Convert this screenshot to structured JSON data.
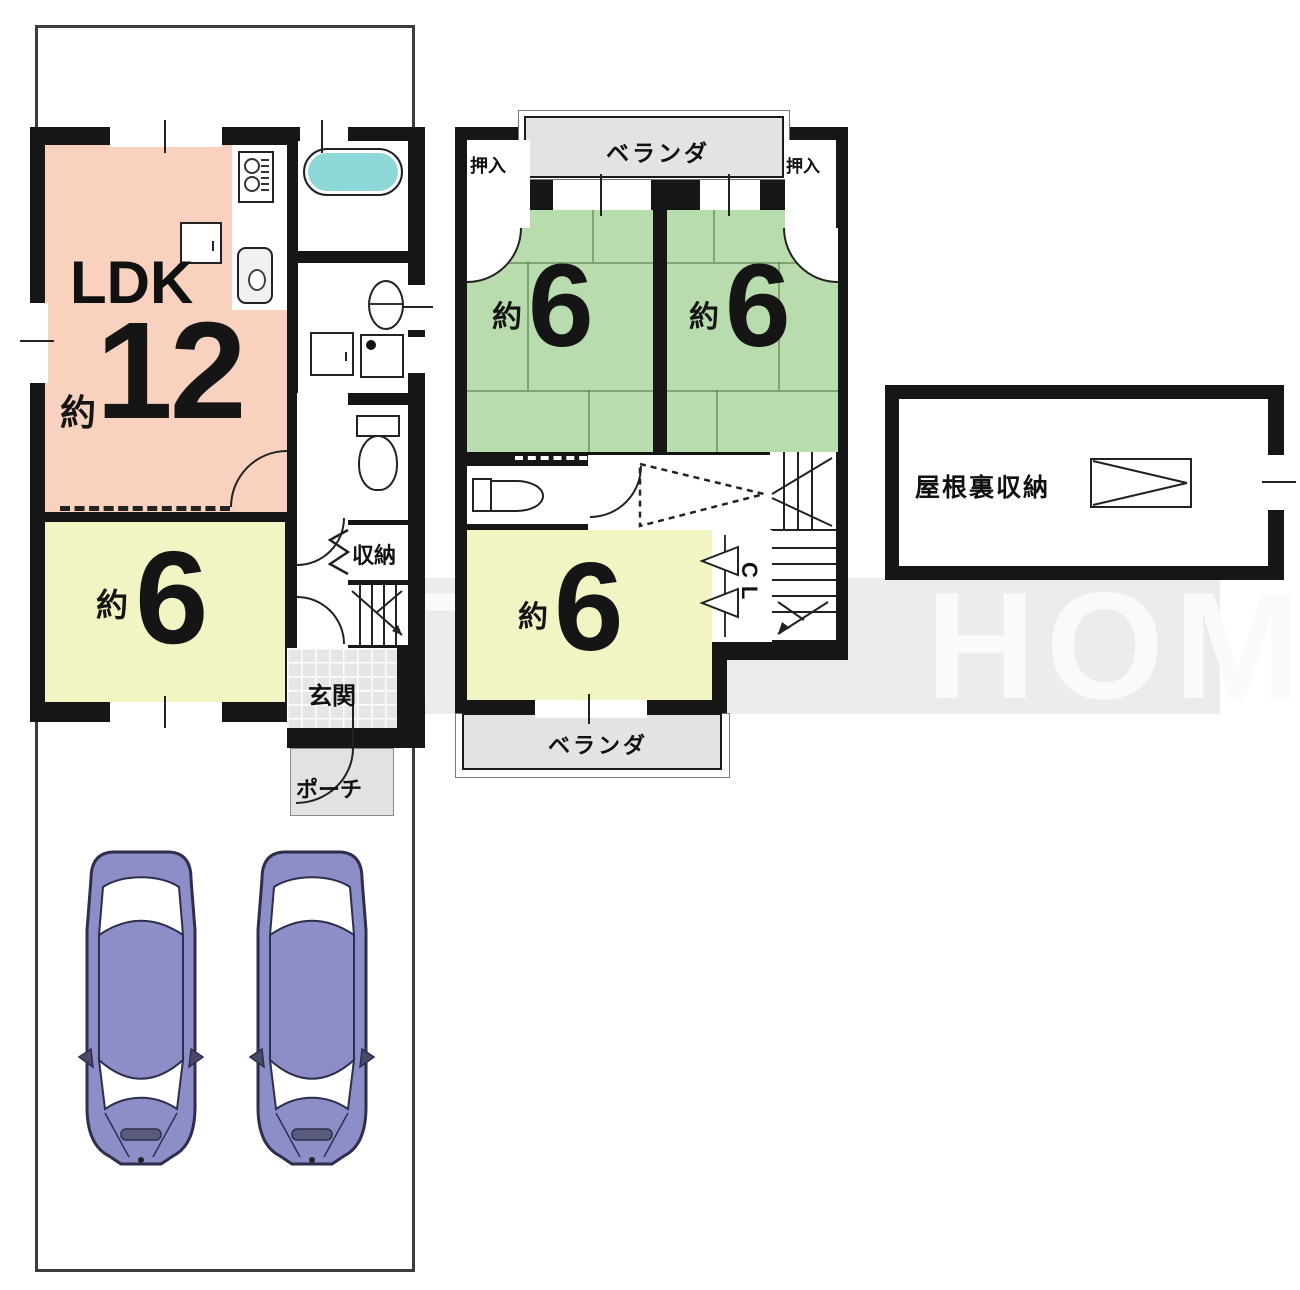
{
  "watermark": {
    "word1": "AFTER",
    "word2": "HOME"
  },
  "floor1": {
    "ldk": {
      "name": "LDK",
      "approx": "約",
      "area": "12"
    },
    "south_room": {
      "approx": "約",
      "area": "6"
    },
    "storage": "収納",
    "entrance": "玄関",
    "porch": "ポーチ"
  },
  "floor2": {
    "north_balcony": "ベランダ",
    "south_balcony": "ベランダ",
    "closet_left": "押入",
    "closet_right": "押入",
    "tatami_left": {
      "approx": "約",
      "area": "6"
    },
    "tatami_right": {
      "approx": "約",
      "area": "6"
    },
    "south_room": {
      "approx": "約",
      "area": "6"
    },
    "closet": "CL"
  },
  "attic": {
    "label": "屋根裏収納"
  },
  "colors": {
    "wall": "#161616",
    "ldk_fill": "#f8d2bf",
    "tatami_fill": "#b9dcae",
    "room6_fill": "#f2f4c3",
    "balcony_fill": "#e3e3e3",
    "bathtub_fill": "#8ed8d8",
    "car_body": "#8d8dc8",
    "watermark_band": "#ececec"
  }
}
